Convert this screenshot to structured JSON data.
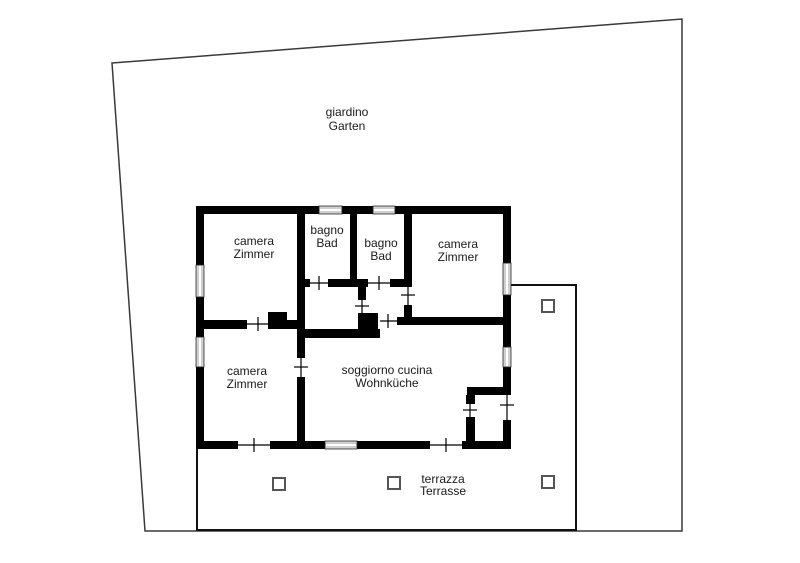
{
  "plan": {
    "type": "floor-plan",
    "colors": {
      "background": "#ffffff",
      "wall": "#000000",
      "site_outline": "#3a3a3a",
      "terrace_outline": "#111111",
      "window_fill": "#cfcfcf",
      "text": "#1a1a1a"
    },
    "garden": {
      "name_it": "giardino",
      "name_de": "Garten"
    },
    "terrace": {
      "name_it": "terrazza",
      "name_de": "Terrasse",
      "pillar_count": 4
    },
    "rooms": [
      {
        "id": "bedroom-top-left",
        "name_it": "camera",
        "name_de": "Zimmer"
      },
      {
        "id": "bathroom-left",
        "name_it": "bagno",
        "name_de": "Bad"
      },
      {
        "id": "bathroom-right",
        "name_it": "bagno",
        "name_de": "Bad"
      },
      {
        "id": "bedroom-top-right",
        "name_it": "camera",
        "name_de": "Zimmer"
      },
      {
        "id": "bedroom-bottom-left",
        "name_it": "camera",
        "name_de": "Zimmer"
      },
      {
        "id": "living-kitchen",
        "name_it": "soggiorno cucina",
        "name_de": "Wohnküche"
      }
    ]
  }
}
